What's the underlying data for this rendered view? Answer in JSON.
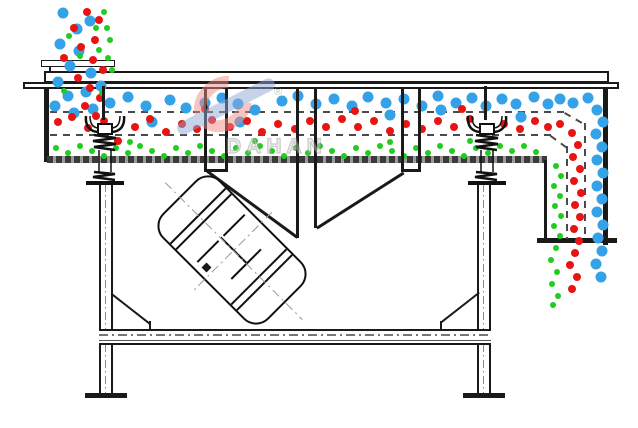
{
  "diagram": {
    "subject": "linear vibrating screen cross-section with particle separation flow",
    "watermark": {
      "brand": "DAHAN",
      "registered_mark": "®"
    },
    "colors": {
      "coarse_particles_blue": "#35a2e8",
      "medium_particles_red": "#e81414",
      "fine_particles_green": "#1fcc1f",
      "outline": "#1a1a1a",
      "deck_dash": "#4a4a4a",
      "watermark_red": "#ef8d84",
      "watermark_blue": "#8fa8d8"
    },
    "particle_diameter": {
      "blue": 11,
      "red": 8,
      "green": 6
    },
    "particles": {
      "blue": [
        [
          63,
          13
        ],
        [
          77,
          29
        ],
        [
          90,
          21
        ],
        [
          60,
          44
        ],
        [
          79,
          51
        ],
        [
          70,
          66
        ],
        [
          91,
          73
        ],
        [
          58,
          82
        ],
        [
          86,
          92
        ],
        [
          101,
          86
        ],
        [
          68,
          96
        ],
        [
          55,
          106
        ],
        [
          93,
          109
        ],
        [
          74,
          113
        ],
        [
          110,
          103
        ],
        [
          128,
          97
        ],
        [
          146,
          106
        ],
        [
          152,
          122
        ],
        [
          170,
          100
        ],
        [
          186,
          108
        ],
        [
          205,
          103
        ],
        [
          222,
          98
        ],
        [
          238,
          104
        ],
        [
          255,
          110
        ],
        [
          240,
          122
        ],
        [
          282,
          101
        ],
        [
          298,
          96
        ],
        [
          316,
          104
        ],
        [
          334,
          99
        ],
        [
          352,
          106
        ],
        [
          368,
          97
        ],
        [
          386,
          103
        ],
        [
          390,
          115
        ],
        [
          404,
          99
        ],
        [
          422,
          106
        ],
        [
          438,
          96
        ],
        [
          441,
          110
        ],
        [
          456,
          103
        ],
        [
          472,
          98
        ],
        [
          486,
          106
        ],
        [
          502,
          99
        ],
        [
          516,
          104
        ],
        [
          521,
          117
        ],
        [
          534,
          97
        ],
        [
          548,
          104
        ],
        [
          560,
          99
        ],
        [
          573,
          103
        ],
        [
          588,
          98
        ],
        [
          597,
          110
        ],
        [
          603,
          122
        ],
        [
          596,
          134
        ],
        [
          602,
          147
        ],
        [
          597,
          160
        ],
        [
          603,
          173
        ],
        [
          597,
          186
        ],
        [
          602,
          199
        ],
        [
          597,
          212
        ],
        [
          603,
          225
        ],
        [
          598,
          238
        ],
        [
          602,
          251
        ],
        [
          596,
          264
        ],
        [
          601,
          277
        ]
      ],
      "red": [
        [
          87,
          12
        ],
        [
          99,
          20
        ],
        [
          74,
          28
        ],
        [
          95,
          40
        ],
        [
          81,
          47
        ],
        [
          64,
          58
        ],
        [
          93,
          60
        ],
        [
          103,
          70
        ],
        [
          78,
          78
        ],
        [
          90,
          88
        ],
        [
          100,
          98
        ],
        [
          85,
          106
        ],
        [
          96,
          116
        ],
        [
          58,
          122
        ],
        [
          72,
          117
        ],
        [
          88,
          128
        ],
        [
          104,
          121
        ],
        [
          118,
          141
        ],
        [
          135,
          127
        ],
        [
          150,
          119
        ],
        [
          166,
          132
        ],
        [
          182,
          124
        ],
        [
          197,
          129
        ],
        [
          212,
          120
        ],
        [
          230,
          127
        ],
        [
          247,
          121
        ],
        [
          262,
          132
        ],
        [
          278,
          124
        ],
        [
          295,
          129
        ],
        [
          310,
          121
        ],
        [
          326,
          127
        ],
        [
          342,
          119
        ],
        [
          358,
          127
        ],
        [
          374,
          121
        ],
        [
          390,
          131
        ],
        [
          406,
          124
        ],
        [
          422,
          129
        ],
        [
          438,
          121
        ],
        [
          454,
          127
        ],
        [
          470,
          119
        ],
        [
          488,
          127
        ],
        [
          504,
          124
        ],
        [
          520,
          129
        ],
        [
          535,
          121
        ],
        [
          548,
          127
        ],
        [
          560,
          124
        ],
        [
          205,
          109
        ],
        [
          355,
          111
        ],
        [
          462,
          109
        ],
        [
          572,
          133
        ],
        [
          578,
          145
        ],
        [
          573,
          157
        ],
        [
          580,
          169
        ],
        [
          574,
          181
        ],
        [
          581,
          193
        ],
        [
          575,
          205
        ],
        [
          580,
          217
        ],
        [
          574,
          229
        ],
        [
          579,
          241
        ],
        [
          575,
          253
        ],
        [
          570,
          265
        ],
        [
          577,
          277
        ],
        [
          572,
          289
        ]
      ],
      "green": [
        [
          104,
          12
        ],
        [
          96,
          28
        ],
        [
          110,
          40
        ],
        [
          69,
          36
        ],
        [
          99,
          50
        ],
        [
          108,
          58
        ],
        [
          80,
          56
        ],
        [
          102,
          93
        ],
        [
          64,
          91
        ],
        [
          112,
          70
        ],
        [
          107,
          28
        ],
        [
          56,
          148
        ],
        [
          68,
          153
        ],
        [
          80,
          146
        ],
        [
          92,
          151
        ],
        [
          104,
          156
        ],
        [
          116,
          148
        ],
        [
          128,
          153
        ],
        [
          140,
          146
        ],
        [
          152,
          151
        ],
        [
          164,
          156
        ],
        [
          176,
          148
        ],
        [
          188,
          153
        ],
        [
          200,
          146
        ],
        [
          212,
          151
        ],
        [
          224,
          156
        ],
        [
          236,
          148
        ],
        [
          248,
          153
        ],
        [
          260,
          146
        ],
        [
          272,
          151
        ],
        [
          284,
          156
        ],
        [
          296,
          148
        ],
        [
          308,
          153
        ],
        [
          320,
          146
        ],
        [
          332,
          151
        ],
        [
          344,
          156
        ],
        [
          356,
          148
        ],
        [
          368,
          153
        ],
        [
          380,
          146
        ],
        [
          392,
          151
        ],
        [
          404,
          156
        ],
        [
          416,
          148
        ],
        [
          428,
          153
        ],
        [
          440,
          146
        ],
        [
          452,
          151
        ],
        [
          464,
          156
        ],
        [
          476,
          148
        ],
        [
          488,
          153
        ],
        [
          500,
          146
        ],
        [
          512,
          151
        ],
        [
          524,
          146
        ],
        [
          536,
          152
        ],
        [
          130,
          142
        ],
        [
          255,
          141
        ],
        [
          390,
          142
        ],
        [
          470,
          141
        ],
        [
          556,
          166
        ],
        [
          561,
          176
        ],
        [
          554,
          186
        ],
        [
          560,
          196
        ],
        [
          555,
          206
        ],
        [
          561,
          216
        ],
        [
          554,
          226
        ],
        [
          560,
          236
        ],
        [
          556,
          248
        ],
        [
          551,
          260
        ],
        [
          557,
          272
        ],
        [
          552,
          284
        ],
        [
          558,
          296
        ],
        [
          553,
          305
        ]
      ]
    }
  }
}
